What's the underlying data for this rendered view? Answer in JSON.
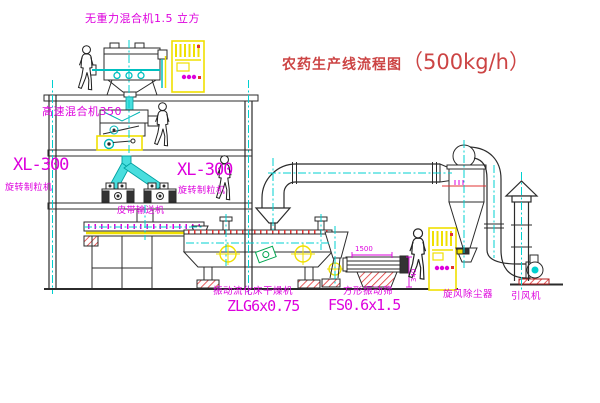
{
  "title": {
    "text": "农药生产线流程图",
    "capacity": "（500kg/h）"
  },
  "equipment": {
    "top_mixer_label": "无重力混合机1.5 立方",
    "high_speed_mixer_label": "高速混合机350",
    "granulator_left": {
      "model": "XL-300",
      "name": "旋转制粒机"
    },
    "granulator_right": {
      "model": "XL-300",
      "name": "旋转制粒机"
    },
    "belt_conveyor_label": "皮带输送机",
    "fluid_bed_dryer": {
      "name": "振动流化床干燥机",
      "model": "ZLG6x0.75"
    },
    "vibrating_sieve": {
      "name": "方形振动筛",
      "model": "FS0.6x1.5"
    },
    "cyclone_label": "旋风除尘器",
    "fan_label": "引风机"
  },
  "dimensions": {
    "sieve_length": "1500",
    "sieve_height": "340"
  },
  "colors": {
    "line": "#2b2b2b",
    "centerline_cyan": "#00d0d0",
    "equipment_yellow": "#f0e000",
    "label_magenta": "#dd00dd",
    "hatch_red": "#e03333",
    "title_red": "#cc4444",
    "motor_green": "#00a550"
  }
}
